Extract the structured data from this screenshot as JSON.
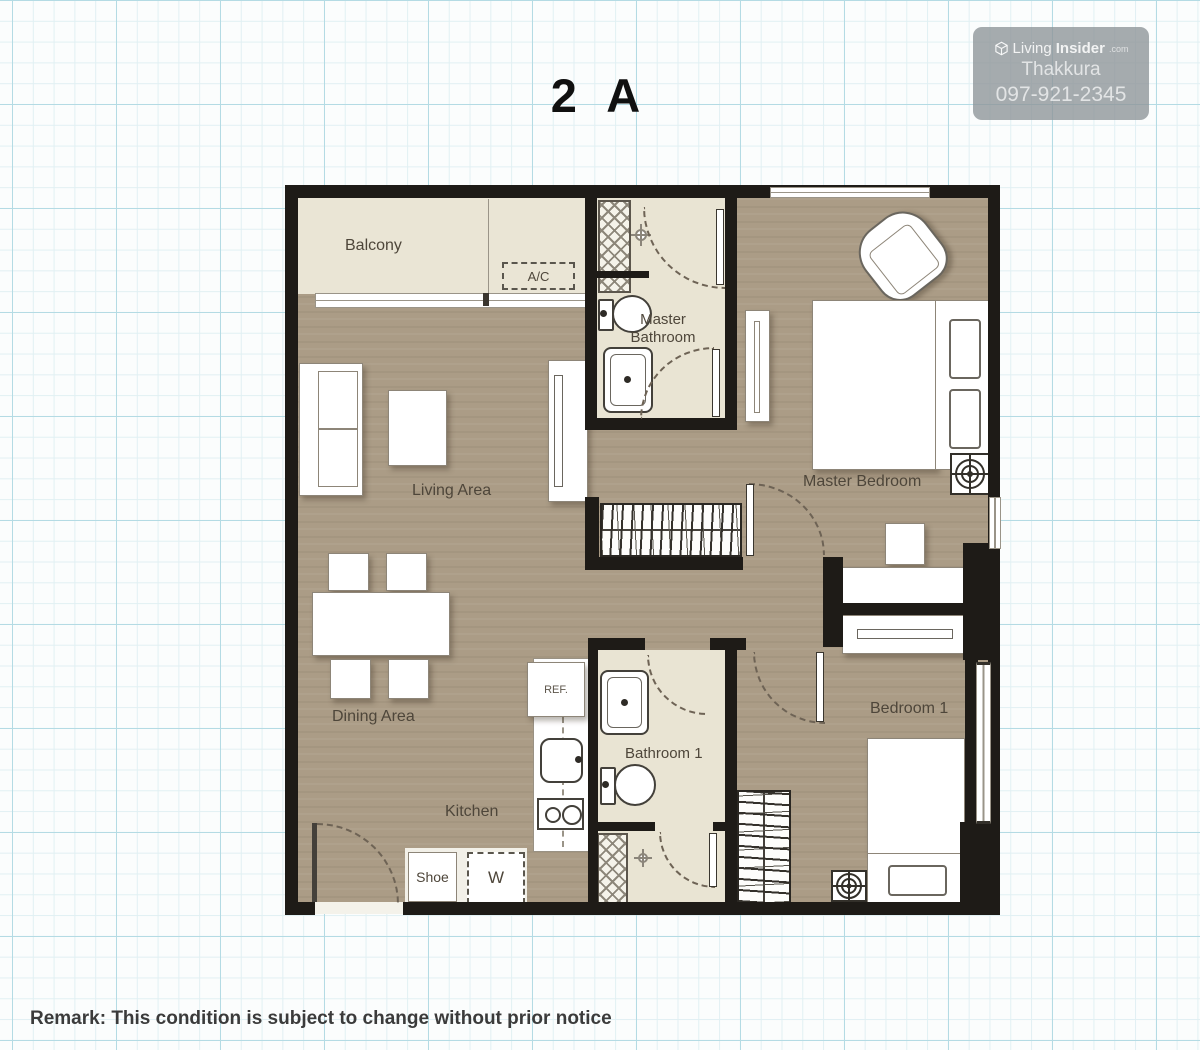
{
  "page": {
    "title": "2 A",
    "remark": "Remark: This condition is subject to change without prior notice"
  },
  "watermark": {
    "brand_living": "Living",
    "brand_insider": "Insider",
    "brand_tld": ".com",
    "name": "Thakkura",
    "phone": "097-921-2345"
  },
  "rooms": {
    "balcony": "Balcony",
    "ac_unit": "A/C",
    "master_bathroom": "Master Bathroom",
    "master_bedroom": "Master Bedroom",
    "living_area": "Living Area",
    "dining_area": "Dining Area",
    "kitchen": "Kitchen",
    "bathroom1": "Bathroom 1",
    "bedroom1": "Bedroom 1",
    "shoe_cabinet": "Shoe",
    "washer": "W",
    "refrigerator": "REF."
  },
  "colors": {
    "wall": "#1e1b17",
    "wood_floor": "#ab9c86",
    "tile_floor": "#e9e4d3",
    "grid_major": "#b4dbe4",
    "grid_minor": "#e1f0f3",
    "watermark_bg": "#8d9397"
  }
}
